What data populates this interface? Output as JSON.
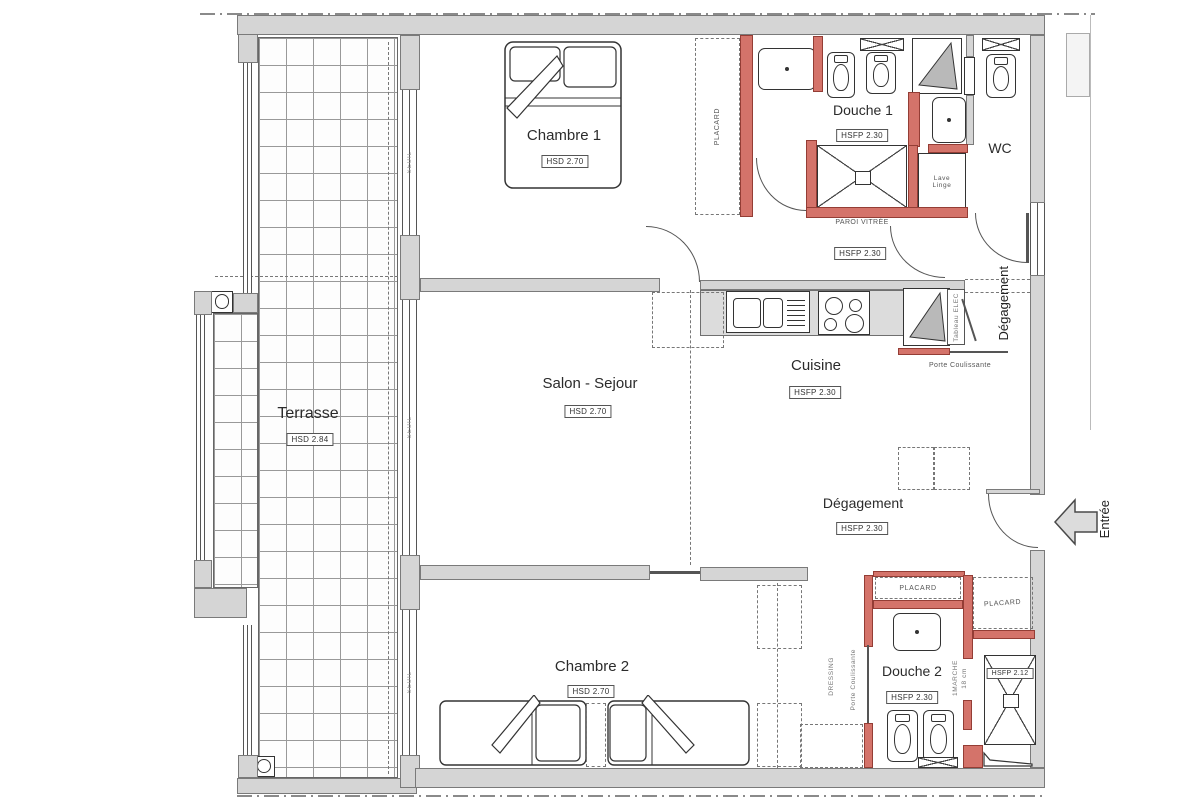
{
  "rooms": {
    "terrasse": {
      "name": "Terrasse",
      "height": "HSD 2.84"
    },
    "chambre1": {
      "name": "Chambre 1",
      "height": "HSD 2.70"
    },
    "douche1": {
      "name": "Douche 1",
      "height": "HSFP 2.30"
    },
    "wc": {
      "name": "WC"
    },
    "salon": {
      "name": "Salon - Sejour",
      "height": "HSD 2.70"
    },
    "cuisine": {
      "name": "Cuisine",
      "height": "HSFP 2.30"
    },
    "hall": {
      "height": "HSFP 2.30"
    },
    "corridor": {
      "name": "Dégagement"
    },
    "degagement": {
      "name": "Dégagement",
      "height": "HSFP 2.30"
    },
    "chambre2": {
      "name": "Chambre 2",
      "height": "HSD 2.70"
    },
    "douche2": {
      "name": "Douche 2",
      "height": "HSFP 2.30",
      "shower_height": "HSFP 2.12"
    }
  },
  "annotations": {
    "placard": "PLACARD",
    "seuil": "SEUIL",
    "paroi_vitree": "PAROI VITRÉE",
    "lave_linge_1": "Lave",
    "lave_linge_2": "Linge",
    "tableau_elec": "Tableau ELEC",
    "porte_coulissante": "Porte Coulissante",
    "dressing": "DRESSING",
    "marche_1": "1MARCHE",
    "marche_2": "18 cm",
    "entree": "Entrée"
  },
  "colors": {
    "wall": "#d5d5d5",
    "partition": "#d4736a",
    "partition_border": "#943d35",
    "line": "#444444"
  }
}
